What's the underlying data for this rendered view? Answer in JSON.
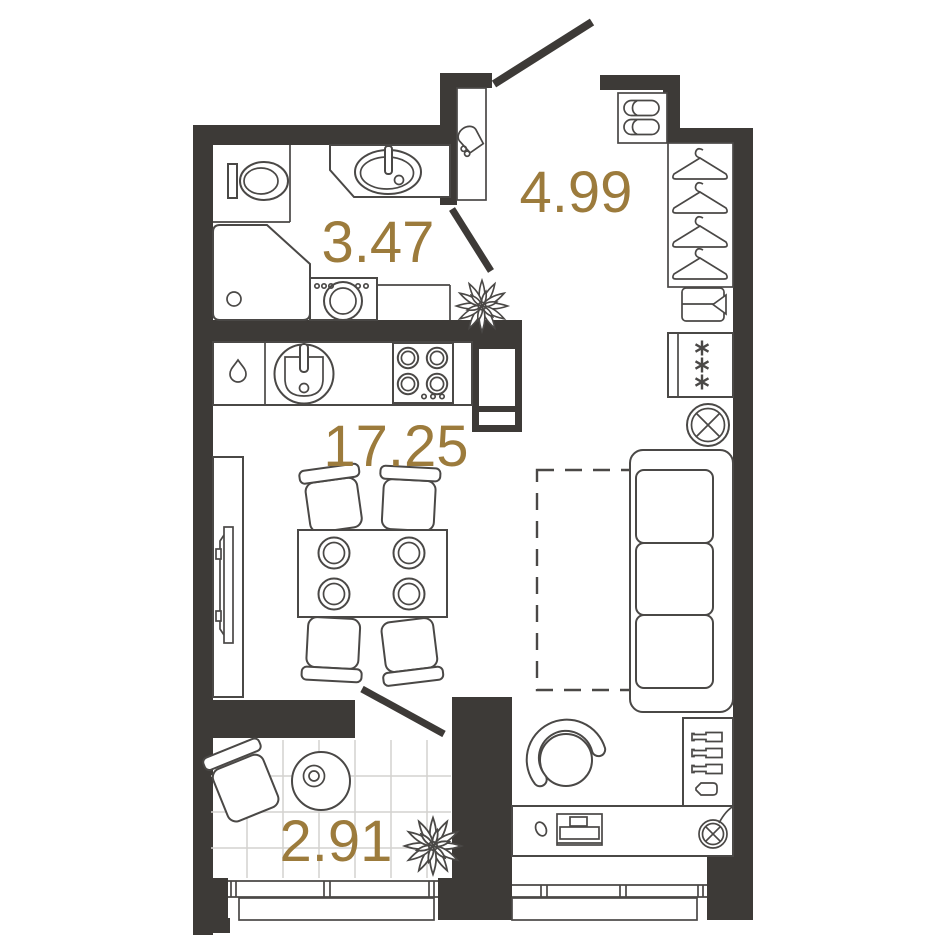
{
  "plan": {
    "rooms": [
      {
        "name": "bathroom",
        "area": "3.47"
      },
      {
        "name": "hallway",
        "area": "4.99"
      },
      {
        "name": "living-kitchen",
        "area": "17.25"
      },
      {
        "name": "balcony",
        "area": "2.91"
      }
    ],
    "colors": {
      "wall": "#3d3a37",
      "line": "#4a4846",
      "label": "#9c7b3c",
      "tile": "#d4d2cf",
      "bg": "#ffffff"
    },
    "icons": [
      "toilet",
      "bathroom-sink",
      "shower",
      "washing-machine",
      "hair-dryer",
      "kitchen-sink",
      "hob",
      "water-drop",
      "slippers",
      "clothes-hanger",
      "drawer-unit",
      "fridge-freezer",
      "ceiling-light",
      "plant",
      "tv",
      "dining-table",
      "plate",
      "dining-chair",
      "sofa",
      "bed-outline",
      "armchair",
      "bottles-shelf",
      "desk",
      "laptop",
      "mouse",
      "wall-lamp",
      "balcony-chair",
      "balcony-table"
    ]
  }
}
